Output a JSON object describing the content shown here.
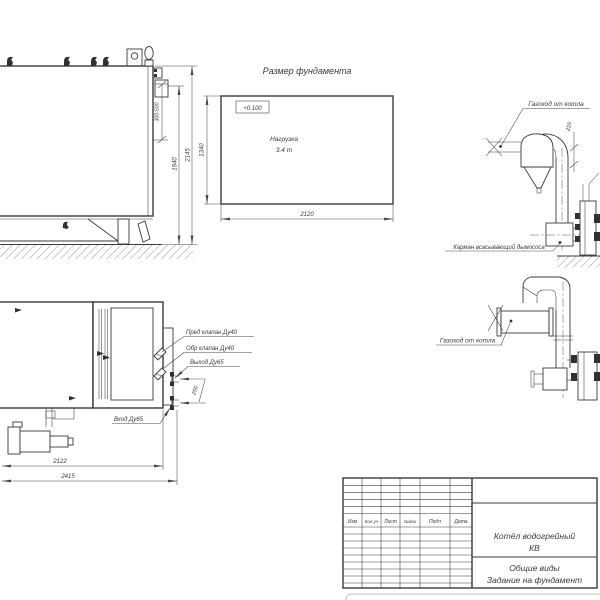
{
  "side_view": {
    "dim_range": "300-500",
    "dim_height_inner": "1940",
    "dim_height_total": "2145"
  },
  "foundation": {
    "title": "Размер фундамента",
    "elevation": "+0.100",
    "load_label": "Нагрузка",
    "load_value": "3.4 т",
    "dim_depth": "1340",
    "dim_width": "2120"
  },
  "duct_top": {
    "gas_label": "Газоход от котла",
    "dim_offset": "225",
    "pocket_label": "Карман всасывающий дымососа"
  },
  "duct_mid": {
    "gas_label": "Газоход от котла"
  },
  "plan_view": {
    "safety_valve_label": "Пред клапан Ду40",
    "check_valve_label": "Обр клапан Ду40",
    "outlet_label": "Выход Ду65",
    "inlet_label": "Вход Ду65",
    "dim_pipe_spacing": "250",
    "dim_length_1": "2122",
    "dim_length_2": "2415"
  },
  "title_block": {
    "headers": [
      "Изм",
      "Кол.уч",
      "Лист",
      "№док",
      "Подп",
      "Дата"
    ],
    "product_line1": "Котёл водогрейный",
    "product_line2": "КВ",
    "view_line1": "Общие виды",
    "view_line2": "Задание на фундамент"
  }
}
